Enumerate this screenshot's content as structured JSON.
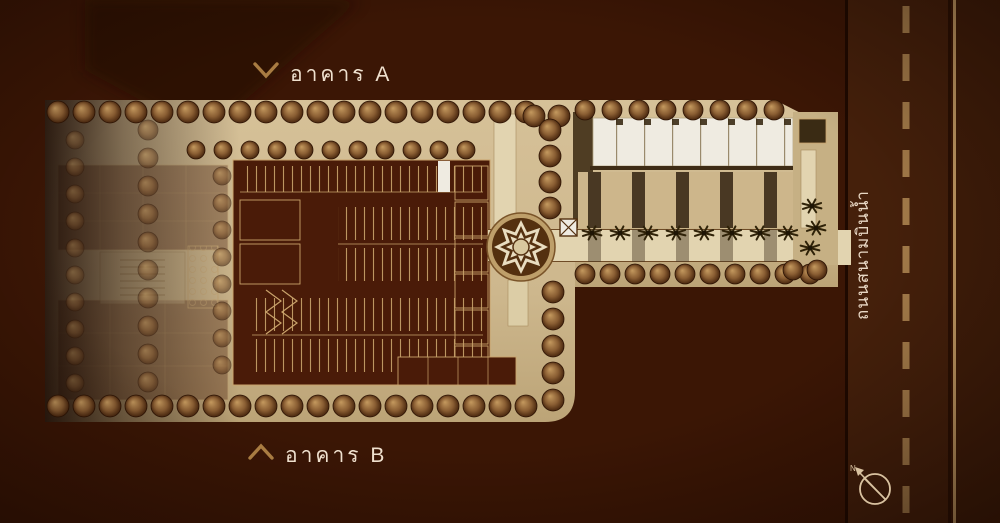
{
  "labels": {
    "building_a": "อาคาร A",
    "building_b": "อาคาร B",
    "road_name": "ถนนสนามบินน้ำ",
    "compass_north": "N"
  },
  "icons": {
    "building_a_chevron": "chevron-down",
    "building_b_chevron": "chevron-up",
    "compass": "compass-rose-northwest"
  },
  "colors": {
    "background": "#3B1605",
    "background_edge": "#240B01",
    "site_tan": "#CDB78D",
    "walkway_cream": "#E2D4B0",
    "white_units": "#EFEBE1",
    "parking_maroon": "#4A1B08",
    "plan_lines": "#C9A36B",
    "dark_strips": "#493823",
    "tree_highlight": "#C59A5F",
    "tree_shadow": "#3C1C07",
    "road_fill": "#45200B",
    "road_dash": "#A57C4A",
    "road_edge_gold": "#C59C64",
    "label_text": "#EFE0CE",
    "chevron_gold": "#A97C42",
    "plaza_dark": "#54300F",
    "plaza_cream": "#E9DDC0"
  }
}
